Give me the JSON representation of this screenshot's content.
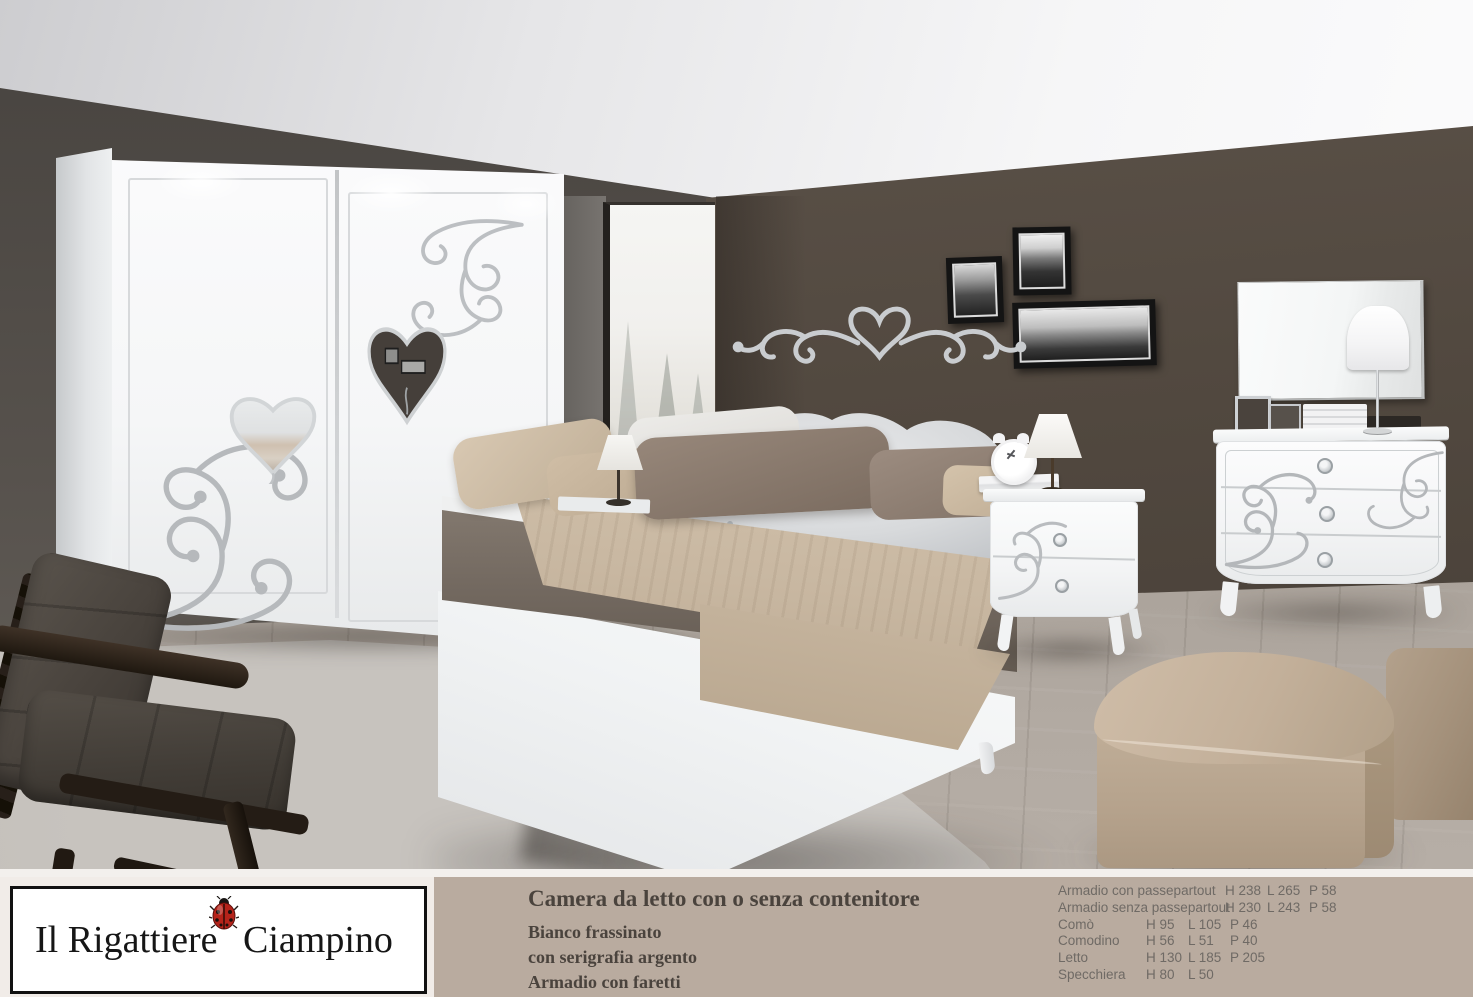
{
  "page": {
    "kind": "furniture-catalog-page",
    "subject": "bedroom set photo with caption"
  },
  "caption": {
    "logo": {
      "text_left": "Il Rigattiere",
      "text_right": "Ciampino",
      "icon": "ladybug-icon"
    },
    "title": "Camera da letto con o senza contenitore",
    "lines": [
      "Bianco frassinato",
      "con serigrafia argento",
      "Armadio con faretti"
    ]
  },
  "dims": {
    "rows": [
      {
        "label": "Armadio con passepartout",
        "values": [
          "H 238",
          "L 265",
          "P 58"
        ]
      },
      {
        "label": "Armadio senza passepartout",
        "values": [
          "H 230",
          "L 243",
          "P 58"
        ]
      },
      {
        "label": "Comò",
        "values": [
          "H 95",
          "L 105",
          "P 46"
        ]
      },
      {
        "label": "Comodino",
        "values": [
          "H 56",
          "L 51",
          "P 40"
        ]
      },
      {
        "label": "Letto",
        "values": [
          "H 130",
          "L 185",
          "P 205"
        ]
      },
      {
        "label": "Specchiera",
        "values": [
          "H 80",
          "L 50"
        ]
      }
    ]
  },
  "colors": {
    "caption_bar": "#b9ab9f",
    "caption_left_panel": "#f1ece8",
    "caption_text": "#4a433d",
    "dims_text": "#6f6a65",
    "wall_dark_brown": "#4f463e",
    "wall_gray": "#5f5a55",
    "wardrobe_white": "#f6f7f8",
    "serigraphy_silver": "#b6b9bc",
    "bedding_taupe": "#746a61",
    "throw_beige": "#c8b7a1",
    "pouf_beige": "#c1ae98",
    "ladybug_red": "#b5231a"
  }
}
